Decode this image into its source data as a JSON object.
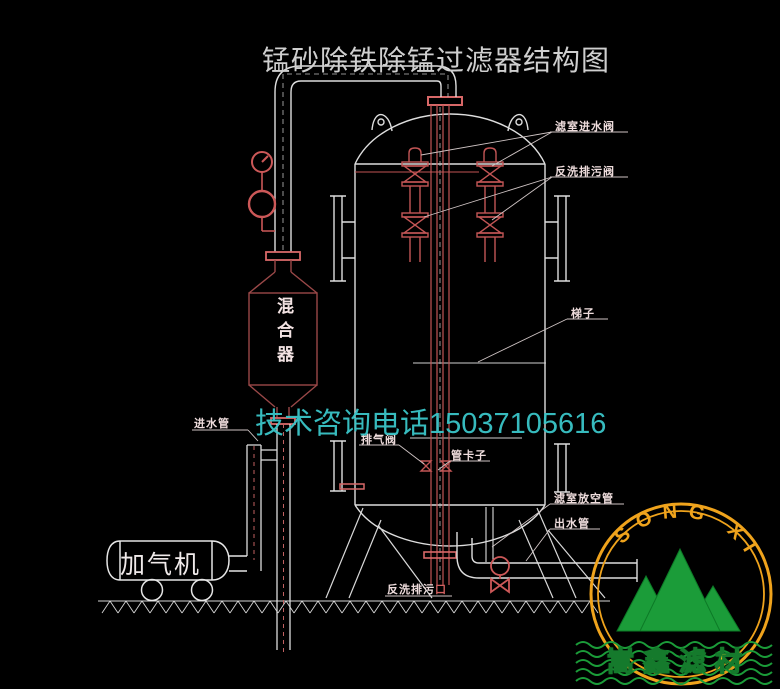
{
  "title": "锰砂除铁除锰过滤器结构图",
  "watermark": "技术咨询电话15037105616",
  "diagram_labels": {
    "filter_inlet_valve": "滤室进水阀",
    "backwash_drain_valve": "反洗排污阀",
    "ladder": "梯子",
    "mixer_vessel": "混合器",
    "inlet_pipe": "进水管",
    "exhaust_valve": "排气阀",
    "pipe_clamp": "管卡子",
    "chamber_vent_pipe": "滤室放空管",
    "outlet_pipe": "出水管",
    "aerator": "加气机",
    "backwash_drain_outlet": "反洗排污",
    "backwash_drain_outlet_suffix": "口"
  },
  "logo": {
    "arc_text": "SONG XIN",
    "company_name": "嵩鑫滤材"
  },
  "colors": {
    "background": "#000000",
    "line_white": "#dedede",
    "pipe_red": "#c25555",
    "flange_red": "#d86868",
    "mixer_red": "#9a4848",
    "label_pink": "#eedcdc",
    "watermark_cyan": "#3ac6c9",
    "logo_orange": "#efa31c",
    "logo_green": "#1b9c39",
    "logo_text_yellow": "#f4c51c"
  }
}
